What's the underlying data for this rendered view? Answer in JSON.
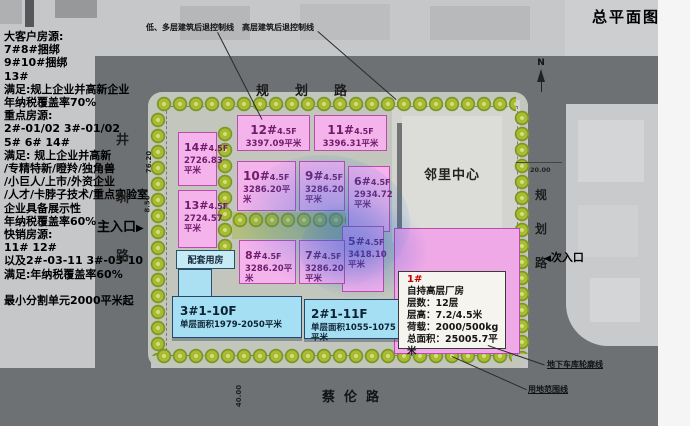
{
  "title": "总平面图",
  "left_panel": {
    "lines": [
      "大客户房源:",
      "7#8#捆绑",
      "9#10#捆绑",
      "13#",
      "满足:规上企业并高新企业",
      "年纳税覆盖率70%",
      "重点房源:",
      "2#-01/02 3#-01/02",
      "5# 6# 14#",
      "满足: 规上企业并高新",
      "/专精特新/瞪羚/独角兽",
      "/小巨人/上市/外资企业",
      "/人才/卡脖子技术/重点实验室",
      "企业具备展示性",
      "年纳税覆盖率60%",
      "快销房源:",
      "11# 12#",
      "以及2#-03-11 3#-03-10",
      "满足:年纳税覆盖率60%",
      "",
      "最小分割单元2000平米起"
    ]
  },
  "annotations": {
    "setback_multi": "低、多层建筑后退控制线",
    "setback_high": "高层建筑后退控制线",
    "garage_outline": "地下车库轮廓线",
    "site_boundary": "用地范围线",
    "main_entrance": "主入口",
    "main_entrance_arrow": "▶",
    "secondary_entrance": "次入口",
    "secondary_entrance_arrow": "◀",
    "north_label": "N"
  },
  "roads": {
    "top": "规划路",
    "left_chars": [
      "井",
      "圳",
      "路"
    ],
    "right_chars": [
      "规",
      "划",
      "路"
    ],
    "bottom": "蔡伦路"
  },
  "dimensions": {
    "left_height": "76.20",
    "left_gate": "8.50",
    "right_width": "20.00",
    "bottom_width": "40.00"
  },
  "neighborhood_center": "邻里中心",
  "support_building": "配套用房",
  "buildings_pink": [
    {
      "num": "12#",
      "floors": "4.5F",
      "area": "3397.09平米"
    },
    {
      "num": "11#",
      "floors": "4.5F",
      "area": "3396.31平米"
    },
    {
      "num": "14#",
      "floors": "4.5F",
      "area": "2726.83平米"
    },
    {
      "num": "13#",
      "floors": "4.5F",
      "area": "2724.57平米"
    },
    {
      "num": "10#",
      "floors": "4.5F",
      "area": "3286.20平米"
    },
    {
      "num": "9#",
      "floors": "4.5F",
      "area": "3286.20平米"
    },
    {
      "num": "6#",
      "floors": "4.5F",
      "area": "2934.72平米"
    },
    {
      "num": "5#",
      "floors": "4.5F",
      "area": "3418.10平米"
    },
    {
      "num": "8#",
      "floors": "4.5F",
      "area": "3286.20平米"
    },
    {
      "num": "7#",
      "floors": "4.5F",
      "area": "3286.20平米"
    }
  ],
  "buildings_blue": [
    {
      "num": "3#",
      "floors": "1-10F",
      "area": "单层面积1979-2050平米"
    },
    {
      "num": "2#",
      "floors": "1-11F",
      "area": "单层面积1055-1075平米"
    }
  ],
  "building1": {
    "id": "1#",
    "lines": [
      "自持高层厂房",
      "层数：12层",
      "层高：7.2/4.5米",
      "荷载：2000/500kg",
      "总面积：25005.7平米"
    ]
  },
  "colors": {
    "pink_building": "#f5b3eb",
    "pink_border": "#bb4cae",
    "blue_building": "#a5dff3",
    "road": "#6e7174",
    "tree": "#a8bc33",
    "watermark_blue": "#2a6fd4",
    "callout_id_red": "#c00000"
  }
}
